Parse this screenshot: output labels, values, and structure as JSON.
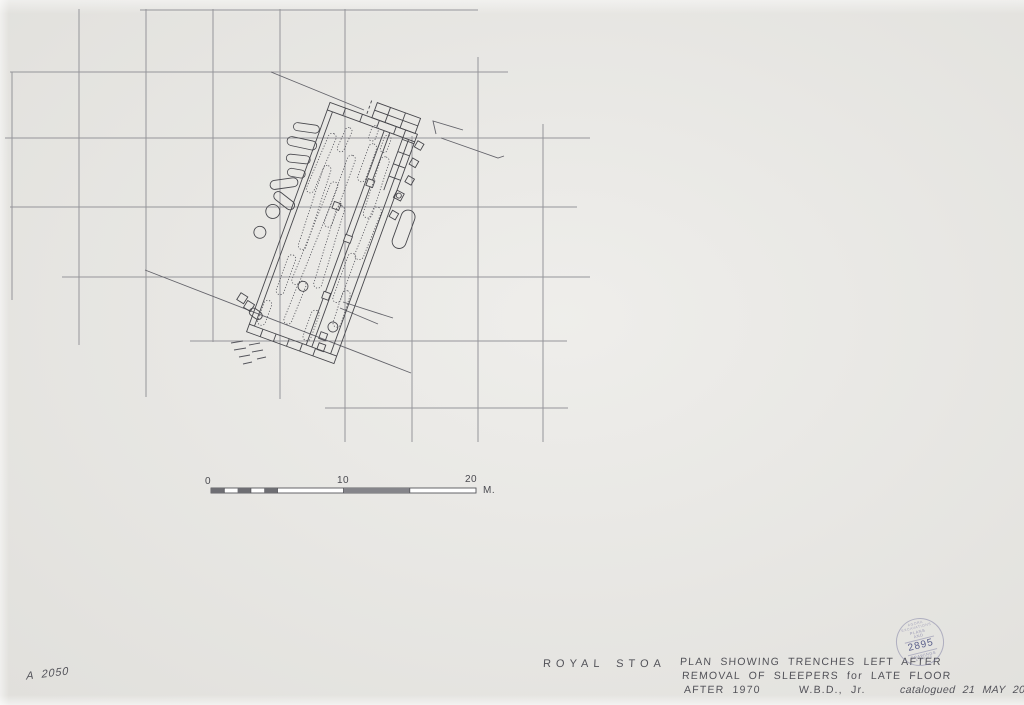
{
  "doc": {
    "drawing_number": "A 2050",
    "site": "ROYAL STOA",
    "caption_line1": "PLAN SHOWING TRENCHES LEFT AFTER",
    "caption_line2": "REMOVAL OF SLEEPERS for LATE FLOOR",
    "caption_date": "AFTER 1970",
    "caption_author": "W.B.D., Jr.",
    "caption_catalog": "catalogued 21 MAY 2003  R.C.A"
  },
  "scale_bar": {
    "tick0": "0",
    "tick10": "10",
    "tick20": "20",
    "unit": "M."
  },
  "stamp": {
    "arc_top": "AGORA EXCAVATIONS",
    "center_line1": "PLANS",
    "center_line2": "AND",
    "center_line3": "DRAWINGS",
    "number": "2895",
    "arc_bottom": "ATHENS"
  },
  "colors": {
    "paper": "#e9e8e4",
    "pencil_grid": "#95959a",
    "ink_plan": "#46464b",
    "graphite_text": "#3e3e46",
    "stamp_purple": "#7a7aa0"
  }
}
